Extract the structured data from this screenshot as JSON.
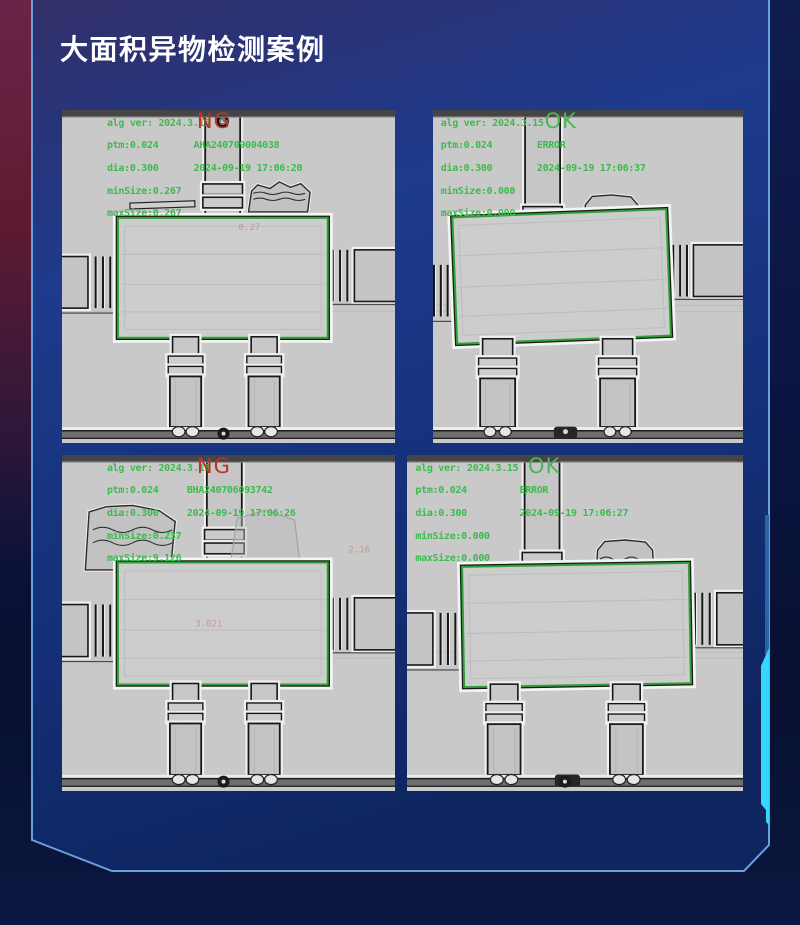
{
  "page": {
    "title": "大面积异物检测案例"
  },
  "theme": {
    "panel_border": "#6aa0dc",
    "accent_cyan": "#37d6ff",
    "accent_dim_blue": "#2565a8",
    "overlay_green": "#3cbb4e",
    "ng_red": "#b5342c",
    "ok_green": "#4fb35a",
    "maroon_corner": "#6f1f38"
  },
  "images": [
    {
      "name": "top-left",
      "status": "NG",
      "status_color": "#b5342c",
      "status_x": 40.5,
      "left_x": 13.5,
      "right_x": 39.5,
      "overlay": {
        "alg_ver": "alg ver: 2024.3.15",
        "ptm": "ptm:0.024",
        "dia": "dia:0.300",
        "min_size": "minSize:0.267",
        "max_size": "maxSize:0.267",
        "serial": "AHA240709004038",
        "datetime": "2024-09-19 17:06:20"
      },
      "faint_marks": [
        {
          "text": "0.27",
          "x": 53,
          "y": 36
        }
      ],
      "scene": {
        "column": {
          "x": 43,
          "w": 10.5,
          "h": 30
        },
        "rings": [
          22.2,
          26.2
        ],
        "top_screw": true,
        "strip": {
          "x": 20.4,
          "y": 27.6,
          "w": 19.5,
          "h": 1.8,
          "rot": -2
        },
        "foil": {
          "x": 56,
          "y": 21.6,
          "w": 18.5,
          "h": 9,
          "style": "loose"
        },
        "box": {
          "x": 16.8,
          "y": 32.4,
          "w": 63,
          "h": 36,
          "rot": 0
        },
        "arm_left_y": 44,
        "arm_right_y": 42,
        "legs": [
          32.4,
          56
        ],
        "leg_w": 9.4,
        "screw_x": 48.5
      }
    },
    {
      "name": "top-right",
      "status": "OK",
      "status_color": "#4fb35a",
      "status_x": 36,
      "left_x": 2.5,
      "right_x": 33.5,
      "overlay": {
        "alg_ver": "alg ver: 2024.3.15",
        "ptm": "ptm:0.024",
        "dia": "dia:0.300",
        "min_size": "minSize:0.000",
        "max_size": "maxSize:0.000",
        "serial": "ERROR",
        "datetime": "2024-09-19 17:06:37"
      },
      "faint_marks": [],
      "scene": {
        "column": {
          "x": 29.7,
          "w": 11.3,
          "h": 40.5
        },
        "rings": [
          29,
          34
        ],
        "top_screw": false,
        "foil": {
          "x": 48.4,
          "y": 25.5,
          "w": 18.4,
          "h": 15,
          "style": "cup"
        },
        "box": {
          "x": 7,
          "y": 31,
          "w": 69,
          "h": 38,
          "rot": -2.2
        },
        "arm_left_y": 46.5,
        "arm_right_y": 40.5,
        "legs": [
          15.2,
          53.9
        ],
        "leg_w": 11.3,
        "dark_blob": {
          "x": 39,
          "w": 7.5
        }
      }
    },
    {
      "name": "bottom-left",
      "status": "NG",
      "status_color": "#b5342c",
      "status_x": 40.5,
      "left_x": 13.5,
      "right_x": 37.5,
      "overlay": {
        "alg_ver": "alg ver: 2024.3.15",
        "ptm": "ptm:0.024",
        "dia": "dia:0.300",
        "min_size": "minSize:0.237",
        "max_size": "maxSize:9.126",
        "serial": "BHA240706093742",
        "datetime": "2024-09-19 17:06:26"
      },
      "faint_marks": [
        {
          "text": "3.021",
          "x": 40,
          "y": 51
        },
        {
          "text": "2.16",
          "x": 86,
          "y": 29
        }
      ],
      "scene": {
        "column": {
          "x": 43.5,
          "w": 10.5,
          "h": 30
        },
        "rings": [
          22.2,
          26.2
        ],
        "top_screw": false,
        "foil": {
          "x": 7,
          "y": 15,
          "w": 28.4,
          "h": 19.2,
          "style": "big"
        },
        "ghost": {
          "x": 50.5,
          "y": 16.4,
          "w": 21,
          "h": 16.3
        },
        "box": {
          "x": 16.8,
          "y": 32,
          "w": 63,
          "h": 36.3,
          "rot": 0
        },
        "arm_left_y": 44.5,
        "arm_right_y": 42.5,
        "legs": [
          32.4,
          56
        ],
        "leg_w": 9.4,
        "screw_x": 48.5
      }
    },
    {
      "name": "bottom-right",
      "status": "OK",
      "status_color": "#4fb35a",
      "status_x": 36,
      "left_x": 2.5,
      "right_x": 33.5,
      "overlay": {
        "alg_ver": "alg ver: 2024.3.15",
        "ptm": "ptm:0.024",
        "dia": "dia:0.300",
        "min_size": "minSize:0.000",
        "max_size": "maxSize:0.000",
        "serial": "ERROR",
        "datetime": "2024-09-19 17:06:27"
      },
      "faint_marks": [],
      "scene": {
        "column": {
          "x": 35,
          "w": 10.4,
          "h": 40
        },
        "rings": [
          29,
          34
        ],
        "top_screw": false,
        "foil": {
          "x": 56,
          "y": 25.3,
          "w": 17.8,
          "h": 14.9,
          "style": "cup"
        },
        "box": {
          "x": 16.7,
          "y": 32.7,
          "w": 67.5,
          "h": 35.8,
          "rot": -1
        },
        "arm_left_y": 47,
        "arm_right_y": 41,
        "legs": [
          24,
          60.4
        ],
        "leg_w": 9.8,
        "dark_blob": {
          "x": 44,
          "w": 7.5
        },
        "screw_x": 47
      }
    }
  ]
}
